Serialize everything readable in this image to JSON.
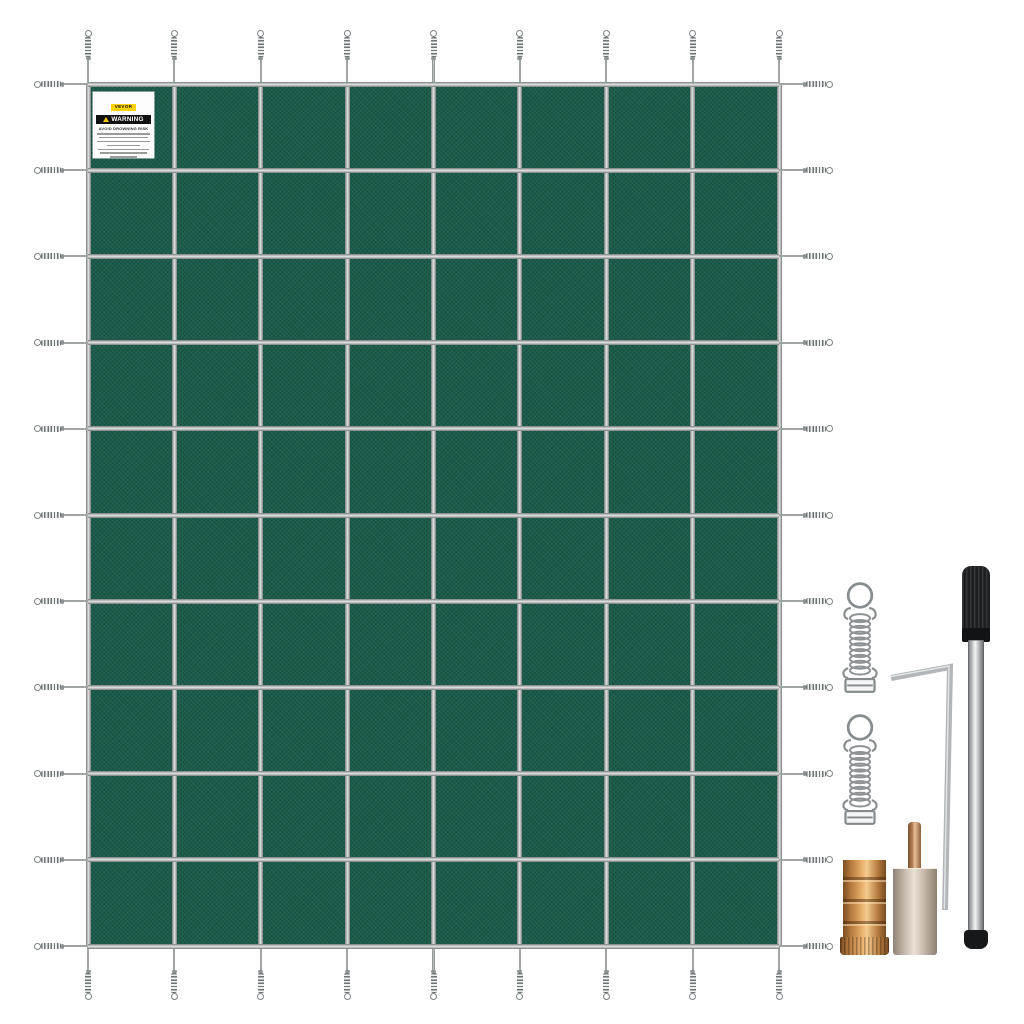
{
  "image": {
    "description": "Product photo of a green rectangular inground pool safety cover with perimeter strap springs, shown with its installation hardware kit",
    "background_color": "#ffffff"
  },
  "cover": {
    "grid_columns": 8,
    "grid_rows": 10,
    "mesh_color": "#1A5B4B",
    "strap_color": "#B9BDBC",
    "spring_steel_color": "#8D9294",
    "label": {
      "brand": "VEVOR",
      "brand_bg": "#FFD400",
      "warning_title": "WARNING",
      "warning_subtitle": "AVOID DROWNING RISK",
      "fine_print_line_count": 7
    }
  },
  "hardware": {
    "brass_color": "#C9924F",
    "steel_color": "#AEB3B5",
    "rod_grip_color": "#1D1E20",
    "items": [
      {
        "name": "tension-spring-1",
        "type": "stainless steel tension spring with ring and buckle"
      },
      {
        "name": "tension-spring-2",
        "type": "stainless steel tension spring with ring and buckle"
      },
      {
        "name": "hex-key",
        "type": "L-shaped hex key"
      },
      {
        "name": "installation-rod",
        "type": "spring installation rod with black grip and end cap"
      },
      {
        "name": "brass-anchor",
        "type": "brass concrete anchor with knurled base"
      },
      {
        "name": "stainless-anchor",
        "type": "anchor cylinder with copper center pin"
      }
    ]
  }
}
